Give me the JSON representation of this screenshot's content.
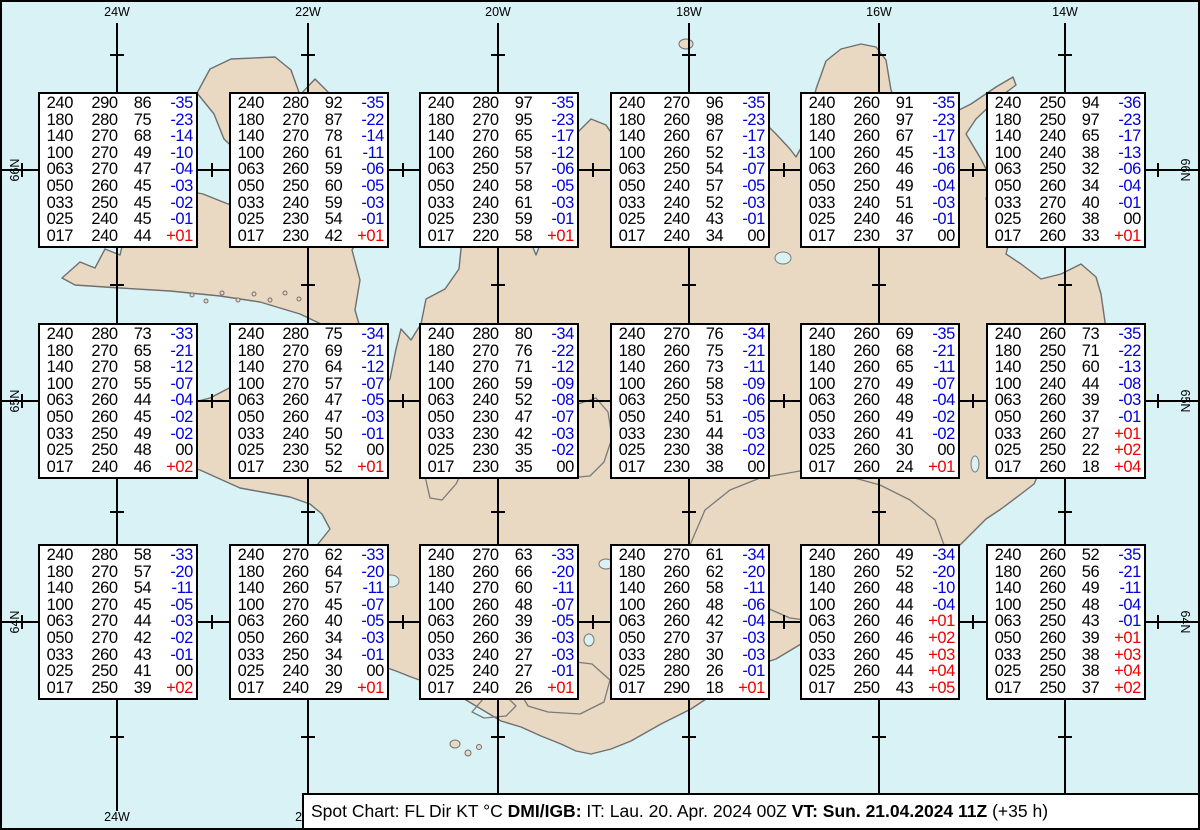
{
  "map": {
    "region": "Iceland",
    "sea_color": "#d9f2f6",
    "land_color": "#e9d9c3",
    "coast_color": "#6f6f6f",
    "grid_color": "#000000",
    "top_longitude_labels": [
      "24W",
      "22W",
      "20W",
      "18W",
      "16W",
      "14W"
    ],
    "bottom_longitude_labels": [
      "24W",
      "22W"
    ],
    "latitude_labels": [
      "66N",
      "65N",
      "64N"
    ]
  },
  "caption": {
    "parts": [
      {
        "text": "Spot Chart: FL Dir KT °C ",
        "bold": false
      },
      {
        "text": "DMI/IGB:",
        "bold": true
      },
      {
        "text": " IT: Lau. 20. Apr. 2024 00Z ",
        "bold": false
      },
      {
        "text": "VT: Sun. 21.04.2024 11Z",
        "bold": true
      },
      {
        "text": " (+35 h)",
        "bold": false
      }
    ]
  },
  "chart_data": {
    "type": "table",
    "title": "Spot Chart: FL Dir KT °C",
    "columns": [
      "FL",
      "Dir",
      "KT",
      "°C"
    ],
    "temp_colors": {
      "negative": "#0000dd",
      "positive": "#ee0000",
      "zero": "#000000"
    },
    "stations": [
      {
        "lon": "24W",
        "lat": "66N",
        "rows": [
          [
            "240",
            "290",
            "86",
            "-35"
          ],
          [
            "180",
            "280",
            "75",
            "-23"
          ],
          [
            "140",
            "270",
            "68",
            "-14"
          ],
          [
            "100",
            "270",
            "49",
            "-10"
          ],
          [
            "063",
            "270",
            "47",
            "-04"
          ],
          [
            "050",
            "260",
            "45",
            "-03"
          ],
          [
            "033",
            "250",
            "45",
            "-02"
          ],
          [
            "025",
            "240",
            "45",
            "-01"
          ],
          [
            "017",
            "240",
            "44",
            "+01"
          ]
        ]
      },
      {
        "lon": "22W",
        "lat": "66N",
        "rows": [
          [
            "240",
            "280",
            "92",
            "-35"
          ],
          [
            "180",
            "270",
            "87",
            "-22"
          ],
          [
            "140",
            "270",
            "78",
            "-14"
          ],
          [
            "100",
            "260",
            "61",
            "-11"
          ],
          [
            "063",
            "260",
            "59",
            "-06"
          ],
          [
            "050",
            "250",
            "60",
            "-05"
          ],
          [
            "033",
            "240",
            "59",
            "-03"
          ],
          [
            "025",
            "230",
            "54",
            "-01"
          ],
          [
            "017",
            "230",
            "42",
            "+01"
          ]
        ]
      },
      {
        "lon": "20W",
        "lat": "66N",
        "rows": [
          [
            "240",
            "280",
            "97",
            "-35"
          ],
          [
            "180",
            "270",
            "95",
            "-23"
          ],
          [
            "140",
            "270",
            "65",
            "-17"
          ],
          [
            "100",
            "260",
            "58",
            "-12"
          ],
          [
            "063",
            "250",
            "57",
            "-06"
          ],
          [
            "050",
            "240",
            "58",
            "-05"
          ],
          [
            "033",
            "240",
            "61",
            "-03"
          ],
          [
            "025",
            "230",
            "59",
            "-01"
          ],
          [
            "017",
            "220",
            "58",
            "+01"
          ]
        ]
      },
      {
        "lon": "18W",
        "lat": "66N",
        "rows": [
          [
            "240",
            "270",
            "96",
            "-35"
          ],
          [
            "180",
            "260",
            "98",
            "-23"
          ],
          [
            "140",
            "260",
            "67",
            "-17"
          ],
          [
            "100",
            "260",
            "52",
            "-13"
          ],
          [
            "063",
            "250",
            "54",
            "-07"
          ],
          [
            "050",
            "240",
            "57",
            "-05"
          ],
          [
            "033",
            "240",
            "52",
            "-03"
          ],
          [
            "025",
            "240",
            "43",
            "-01"
          ],
          [
            "017",
            "240",
            "34",
            "00"
          ]
        ]
      },
      {
        "lon": "16W",
        "lat": "66N",
        "rows": [
          [
            "240",
            "260",
            "91",
            "-35"
          ],
          [
            "180",
            "260",
            "97",
            "-23"
          ],
          [
            "140",
            "260",
            "67",
            "-17"
          ],
          [
            "100",
            "260",
            "45",
            "-13"
          ],
          [
            "063",
            "260",
            "46",
            "-06"
          ],
          [
            "050",
            "250",
            "49",
            "-04"
          ],
          [
            "033",
            "240",
            "51",
            "-03"
          ],
          [
            "025",
            "240",
            "46",
            "-01"
          ],
          [
            "017",
            "230",
            "37",
            "00"
          ]
        ]
      },
      {
        "lon": "14W",
        "lat": "66N",
        "rows": [
          [
            "240",
            "250",
            "94",
            "-36"
          ],
          [
            "180",
            "250",
            "97",
            "-23"
          ],
          [
            "140",
            "240",
            "65",
            "-17"
          ],
          [
            "100",
            "240",
            "38",
            "-13"
          ],
          [
            "063",
            "250",
            "32",
            "-06"
          ],
          [
            "050",
            "260",
            "34",
            "-04"
          ],
          [
            "033",
            "270",
            "40",
            "-01"
          ],
          [
            "025",
            "260",
            "38",
            "00"
          ],
          [
            "017",
            "260",
            "33",
            "+01"
          ]
        ]
      },
      {
        "lon": "24W",
        "lat": "65N",
        "rows": [
          [
            "240",
            "280",
            "73",
            "-33"
          ],
          [
            "180",
            "270",
            "65",
            "-21"
          ],
          [
            "140",
            "270",
            "58",
            "-12"
          ],
          [
            "100",
            "270",
            "55",
            "-07"
          ],
          [
            "063",
            "260",
            "44",
            "-04"
          ],
          [
            "050",
            "260",
            "45",
            "-02"
          ],
          [
            "033",
            "250",
            "49",
            "-02"
          ],
          [
            "025",
            "250",
            "48",
            "00"
          ],
          [
            "017",
            "240",
            "46",
            "+02"
          ]
        ]
      },
      {
        "lon": "22W",
        "lat": "65N",
        "rows": [
          [
            "240",
            "280",
            "75",
            "-34"
          ],
          [
            "180",
            "270",
            "69",
            "-21"
          ],
          [
            "140",
            "270",
            "64",
            "-12"
          ],
          [
            "100",
            "270",
            "57",
            "-07"
          ],
          [
            "063",
            "260",
            "47",
            "-05"
          ],
          [
            "050",
            "260",
            "47",
            "-03"
          ],
          [
            "033",
            "240",
            "50",
            "-01"
          ],
          [
            "025",
            "230",
            "52",
            "00"
          ],
          [
            "017",
            "230",
            "52",
            "+01"
          ]
        ]
      },
      {
        "lon": "20W",
        "lat": "65N",
        "rows": [
          [
            "240",
            "280",
            "80",
            "-34"
          ],
          [
            "180",
            "270",
            "76",
            "-22"
          ],
          [
            "140",
            "270",
            "71",
            "-12"
          ],
          [
            "100",
            "260",
            "59",
            "-09"
          ],
          [
            "063",
            "240",
            "52",
            "-08"
          ],
          [
            "050",
            "230",
            "47",
            "-07"
          ],
          [
            "033",
            "230",
            "42",
            "-03"
          ],
          [
            "025",
            "230",
            "35",
            "-02"
          ],
          [
            "017",
            "230",
            "35",
            "00"
          ]
        ]
      },
      {
        "lon": "18W",
        "lat": "65N",
        "rows": [
          [
            "240",
            "270",
            "76",
            "-34"
          ],
          [
            "180",
            "260",
            "75",
            "-21"
          ],
          [
            "140",
            "260",
            "73",
            "-11"
          ],
          [
            "100",
            "260",
            "58",
            "-09"
          ],
          [
            "063",
            "250",
            "53",
            "-06"
          ],
          [
            "050",
            "240",
            "51",
            "-05"
          ],
          [
            "033",
            "230",
            "44",
            "-03"
          ],
          [
            "025",
            "230",
            "38",
            "-02"
          ],
          [
            "017",
            "230",
            "38",
            "00"
          ]
        ]
      },
      {
        "lon": "16W",
        "lat": "65N",
        "rows": [
          [
            "240",
            "260",
            "69",
            "-35"
          ],
          [
            "180",
            "260",
            "68",
            "-21"
          ],
          [
            "140",
            "260",
            "65",
            "-11"
          ],
          [
            "100",
            "270",
            "49",
            "-07"
          ],
          [
            "063",
            "260",
            "48",
            "-04"
          ],
          [
            "050",
            "260",
            "49",
            "-02"
          ],
          [
            "033",
            "260",
            "41",
            "-02"
          ],
          [
            "025",
            "260",
            "30",
            "00"
          ],
          [
            "017",
            "260",
            "24",
            "+01"
          ]
        ]
      },
      {
        "lon": "14W",
        "lat": "65N",
        "rows": [
          [
            "240",
            "260",
            "73",
            "-35"
          ],
          [
            "180",
            "250",
            "71",
            "-22"
          ],
          [
            "140",
            "250",
            "60",
            "-13"
          ],
          [
            "100",
            "240",
            "44",
            "-08"
          ],
          [
            "063",
            "260",
            "39",
            "-03"
          ],
          [
            "050",
            "260",
            "37",
            "-01"
          ],
          [
            "033",
            "260",
            "27",
            "+01"
          ],
          [
            "025",
            "250",
            "22",
            "+02"
          ],
          [
            "017",
            "260",
            "18",
            "+04"
          ]
        ]
      },
      {
        "lon": "24W",
        "lat": "64N",
        "rows": [
          [
            "240",
            "280",
            "58",
            "-33"
          ],
          [
            "180",
            "270",
            "57",
            "-20"
          ],
          [
            "140",
            "260",
            "54",
            "-11"
          ],
          [
            "100",
            "270",
            "45",
            "-05"
          ],
          [
            "063",
            "270",
            "44",
            "-03"
          ],
          [
            "050",
            "270",
            "42",
            "-02"
          ],
          [
            "033",
            "260",
            "43",
            "-01"
          ],
          [
            "025",
            "250",
            "41",
            "00"
          ],
          [
            "017",
            "250",
            "39",
            "+02"
          ]
        ]
      },
      {
        "lon": "22W",
        "lat": "64N",
        "rows": [
          [
            "240",
            "270",
            "62",
            "-33"
          ],
          [
            "180",
            "260",
            "64",
            "-20"
          ],
          [
            "140",
            "260",
            "57",
            "-11"
          ],
          [
            "100",
            "270",
            "45",
            "-07"
          ],
          [
            "063",
            "260",
            "40",
            "-05"
          ],
          [
            "050",
            "260",
            "34",
            "-03"
          ],
          [
            "033",
            "250",
            "34",
            "-01"
          ],
          [
            "025",
            "240",
            "30",
            "00"
          ],
          [
            "017",
            "240",
            "29",
            "+01"
          ]
        ]
      },
      {
        "lon": "20W",
        "lat": "64N",
        "rows": [
          [
            "240",
            "270",
            "63",
            "-33"
          ],
          [
            "180",
            "260",
            "66",
            "-20"
          ],
          [
            "140",
            "270",
            "60",
            "-11"
          ],
          [
            "100",
            "260",
            "48",
            "-07"
          ],
          [
            "063",
            "260",
            "39",
            "-05"
          ],
          [
            "050",
            "260",
            "36",
            "-03"
          ],
          [
            "033",
            "240",
            "27",
            "-03"
          ],
          [
            "025",
            "240",
            "27",
            "-01"
          ],
          [
            "017",
            "240",
            "26",
            "+01"
          ]
        ]
      },
      {
        "lon": "18W",
        "lat": "64N",
        "rows": [
          [
            "240",
            "270",
            "61",
            "-34"
          ],
          [
            "180",
            "260",
            "62",
            "-20"
          ],
          [
            "140",
            "260",
            "58",
            "-11"
          ],
          [
            "100",
            "260",
            "48",
            "-06"
          ],
          [
            "063",
            "260",
            "42",
            "-04"
          ],
          [
            "050",
            "270",
            "37",
            "-03"
          ],
          [
            "033",
            "280",
            "30",
            "-03"
          ],
          [
            "025",
            "280",
            "26",
            "-01"
          ],
          [
            "017",
            "290",
            "18",
            "+01"
          ]
        ]
      },
      {
        "lon": "16W",
        "lat": "64N",
        "rows": [
          [
            "240",
            "260",
            "49",
            "-34"
          ],
          [
            "180",
            "260",
            "52",
            "-20"
          ],
          [
            "140",
            "260",
            "48",
            "-10"
          ],
          [
            "100",
            "260",
            "44",
            "-04"
          ],
          [
            "063",
            "260",
            "46",
            "+01"
          ],
          [
            "050",
            "260",
            "46",
            "+02"
          ],
          [
            "033",
            "260",
            "45",
            "+03"
          ],
          [
            "025",
            "260",
            "44",
            "+04"
          ],
          [
            "017",
            "250",
            "43",
            "+05"
          ]
        ]
      },
      {
        "lon": "14W",
        "lat": "64N",
        "rows": [
          [
            "240",
            "260",
            "52",
            "-35"
          ],
          [
            "180",
            "260",
            "56",
            "-21"
          ],
          [
            "140",
            "260",
            "49",
            "-11"
          ],
          [
            "100",
            "250",
            "48",
            "-04"
          ],
          [
            "063",
            "250",
            "43",
            "-01"
          ],
          [
            "050",
            "260",
            "39",
            "+01"
          ],
          [
            "033",
            "250",
            "38",
            "+03"
          ],
          [
            "025",
            "250",
            "38",
            "+04"
          ],
          [
            "017",
            "250",
            "37",
            "+02"
          ]
        ]
      }
    ]
  }
}
